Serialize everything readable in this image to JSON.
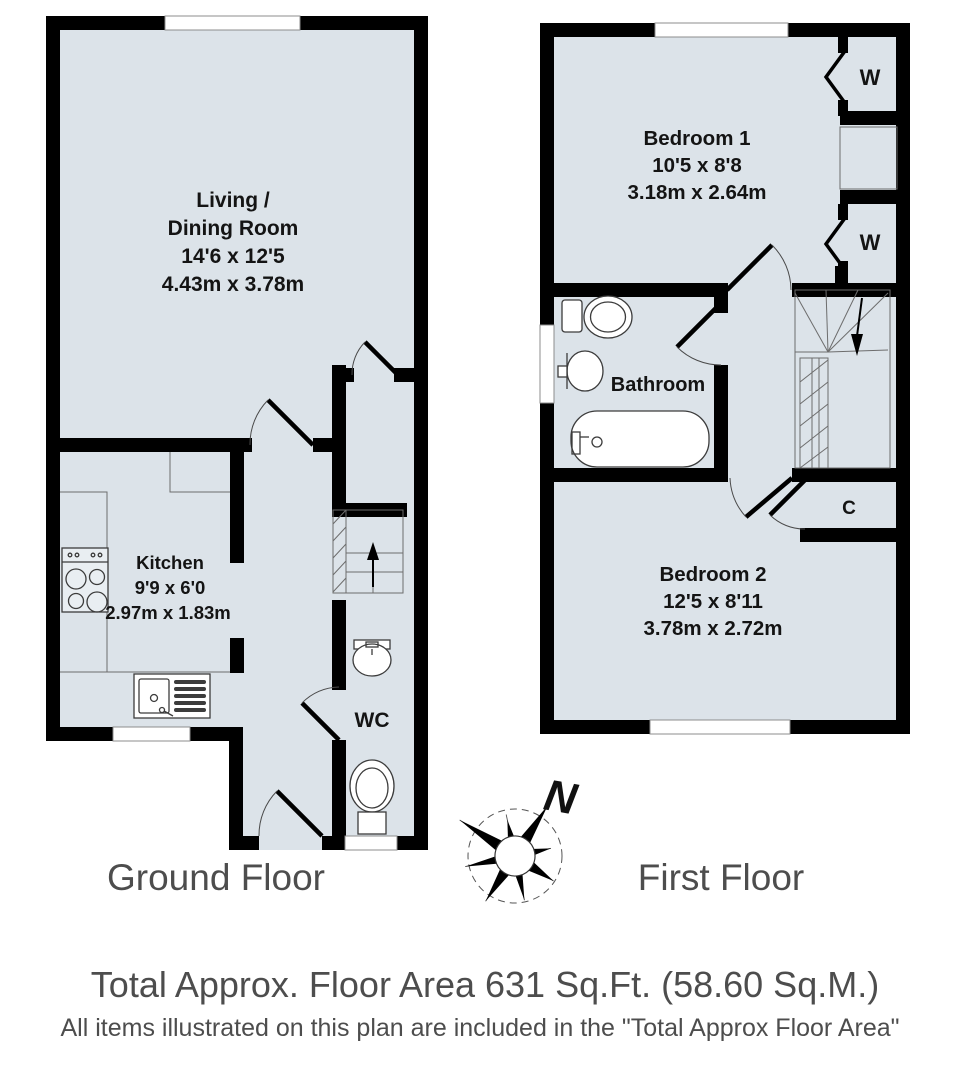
{
  "colors": {
    "room_fill": "#dce3e9",
    "wall": "#000000",
    "label_gray": "#4d4d4d"
  },
  "ground_floor": {
    "label": "Ground Floor",
    "living_room": {
      "line1": "Living /",
      "line2": "Dining Room",
      "dims_ft": "14'6 x 12'5",
      "dims_m": "4.43m x 3.78m"
    },
    "kitchen": {
      "name": "Kitchen",
      "dims_ft": "9'9 x 6'0",
      "dims_m": "2.97m x 1.83m"
    },
    "wc": {
      "name": "WC"
    }
  },
  "first_floor": {
    "label": "First Floor",
    "bedroom1": {
      "name": "Bedroom 1",
      "dims_ft": "10'5 x 8'8",
      "dims_m": "3.18m x 2.64m"
    },
    "bedroom2": {
      "name": "Bedroom 2",
      "dims_ft": "12'5 x 8'11",
      "dims_m": "3.78m x 2.72m"
    },
    "bathroom": {
      "name": "Bathroom"
    },
    "wardrobe_top": {
      "label": "W"
    },
    "wardrobe_bottom": {
      "label": "W"
    },
    "cupboard": {
      "label": "C"
    }
  },
  "compass": {
    "north": "N"
  },
  "footer": {
    "line1": "Total Approx. Floor Area 631 Sq.Ft. (58.60 Sq.M.)",
    "line2": "All items illustrated on this plan are included in the \"Total Approx Floor Area\""
  }
}
